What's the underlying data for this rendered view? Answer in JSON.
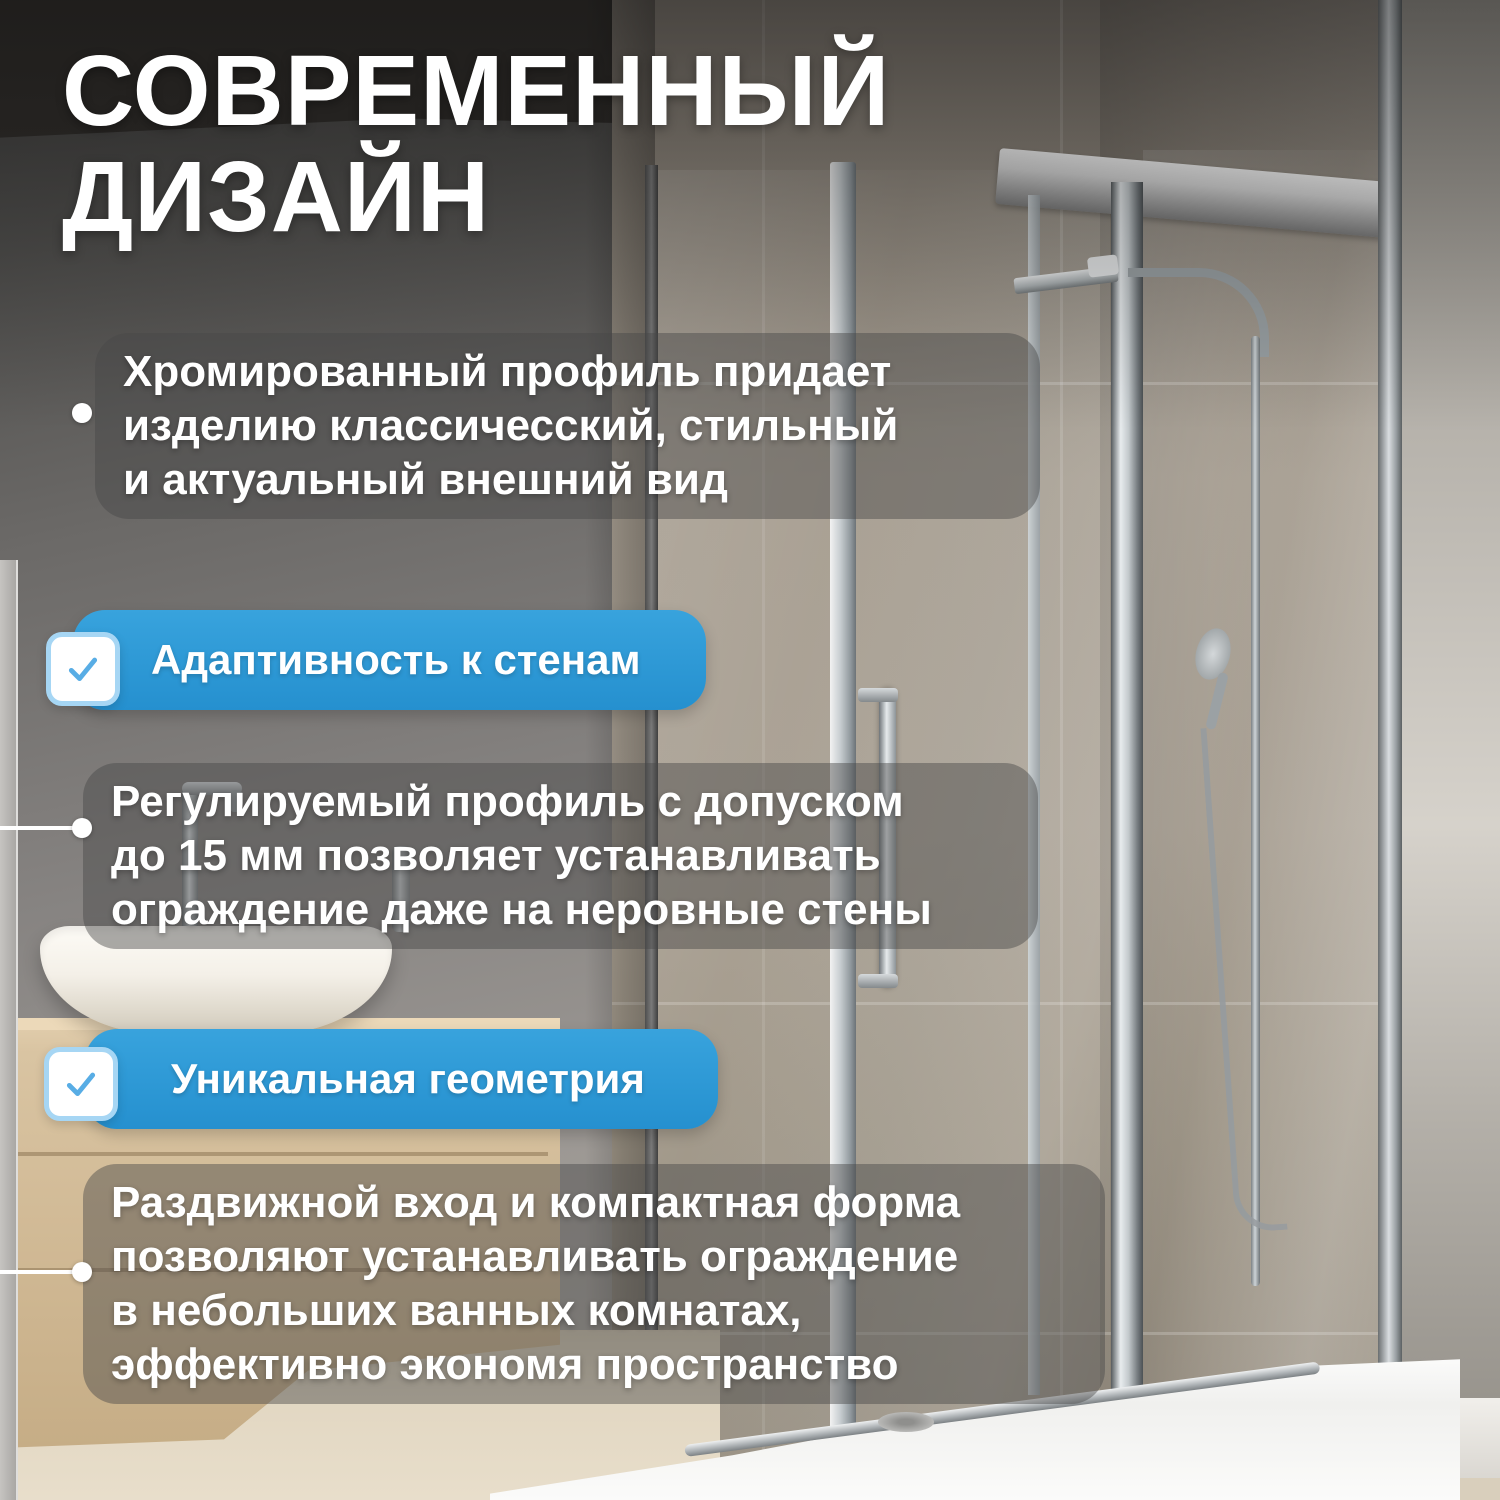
{
  "page": {
    "title_line1": "СОВРЕМЕННЫЙ",
    "title_line2": "ДИЗАЙН"
  },
  "features": {
    "para1": {
      "marker": "dot",
      "text": "Хромированный профиль придает\nизделию классичесский, стильный\nи актуальный внешний вид"
    },
    "banner1": {
      "icon": "checkbox-check-icon",
      "label": "Адаптивность к стенам"
    },
    "para2": {
      "marker": "dot-with-line",
      "text": "Регулируемый профиль с допуском\nдо 15 мм позволяет устанавливать\nограждение даже на неровные стены"
    },
    "banner2": {
      "icon": "checkbox-check-icon",
      "label": "Уникальная геометрия"
    },
    "para3": {
      "marker": "dot-with-line",
      "text": "Раздвижной вход и компактная форма\nпозволяют устанавливать ограждение\nв небольших ванных комнатах,\nэффективно экономя пространство"
    }
  },
  "colors": {
    "banner_blue": "#2d9ad7",
    "checkbox_border": "#a6d6f4",
    "checkmark_blue": "#58ade5",
    "text_white": "#ffffff",
    "panel_overlay": "rgba(72,72,72,0.45)"
  },
  "icons": [
    {
      "name": "checkbox-check-icon",
      "glyph": "✓"
    }
  ],
  "photo_description": "Bathroom with chrome-framed sliding shower enclosure, rain shower, hand shower, white vessel sink on wooden vanity, white low shower tray"
}
